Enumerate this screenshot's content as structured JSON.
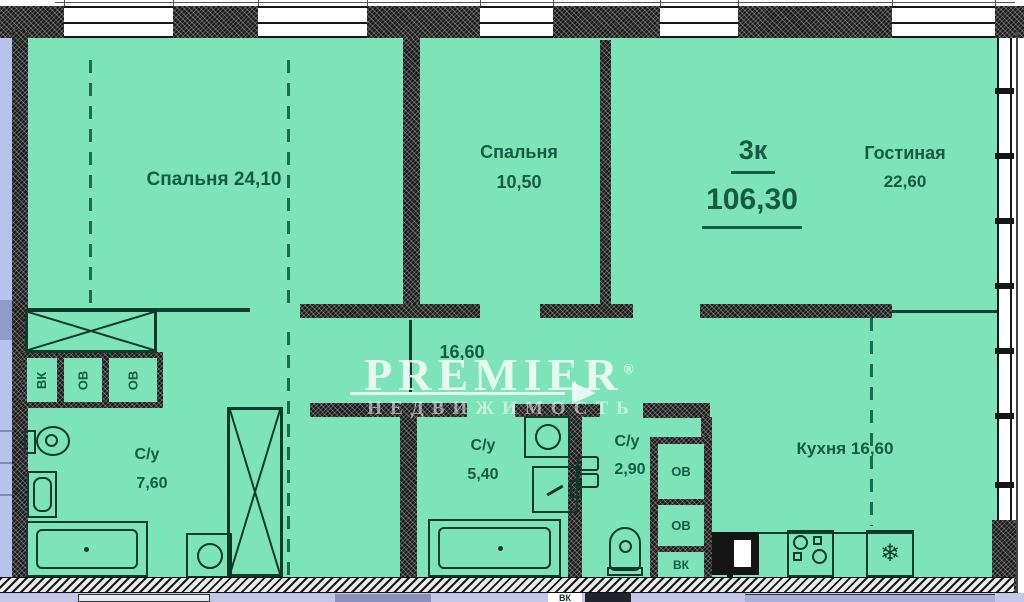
{
  "plan": {
    "apartment": {
      "type_label": "3к",
      "total_area": "106,30"
    },
    "rooms": {
      "bedroom1": {
        "label": "Спальня 24,10"
      },
      "bedroom2": {
        "name": "Спальня",
        "area": "10,50"
      },
      "living": {
        "name": "Гостиная",
        "area": "22,60"
      },
      "hallway": {
        "area": "16,60"
      },
      "bath_main": {
        "name": "С/у",
        "area": "7,60"
      },
      "bath_second": {
        "name": "С/у",
        "area": "5,40"
      },
      "bath_guest": {
        "name": "С/у",
        "area": "2,90"
      },
      "kitchen": {
        "label": "Кухня 16,60"
      }
    },
    "shafts": {
      "left_block": [
        "ВК",
        "ОВ",
        "ОВ"
      ],
      "right_block": [
        "ОВ",
        "ОВ",
        "ВК"
      ],
      "lower_floor": "ВК"
    },
    "watermark": {
      "brand": "PREMIER",
      "reg": "®",
      "subtitle": "НЕДВИЖИМОСТЬ"
    },
    "colors": {
      "floor": "#7de3b8",
      "wall": "#191919",
      "label": "#155a43",
      "adjacent_left": "#b7c3ec",
      "adjacent_bottom": "#c6c6e8"
    }
  }
}
